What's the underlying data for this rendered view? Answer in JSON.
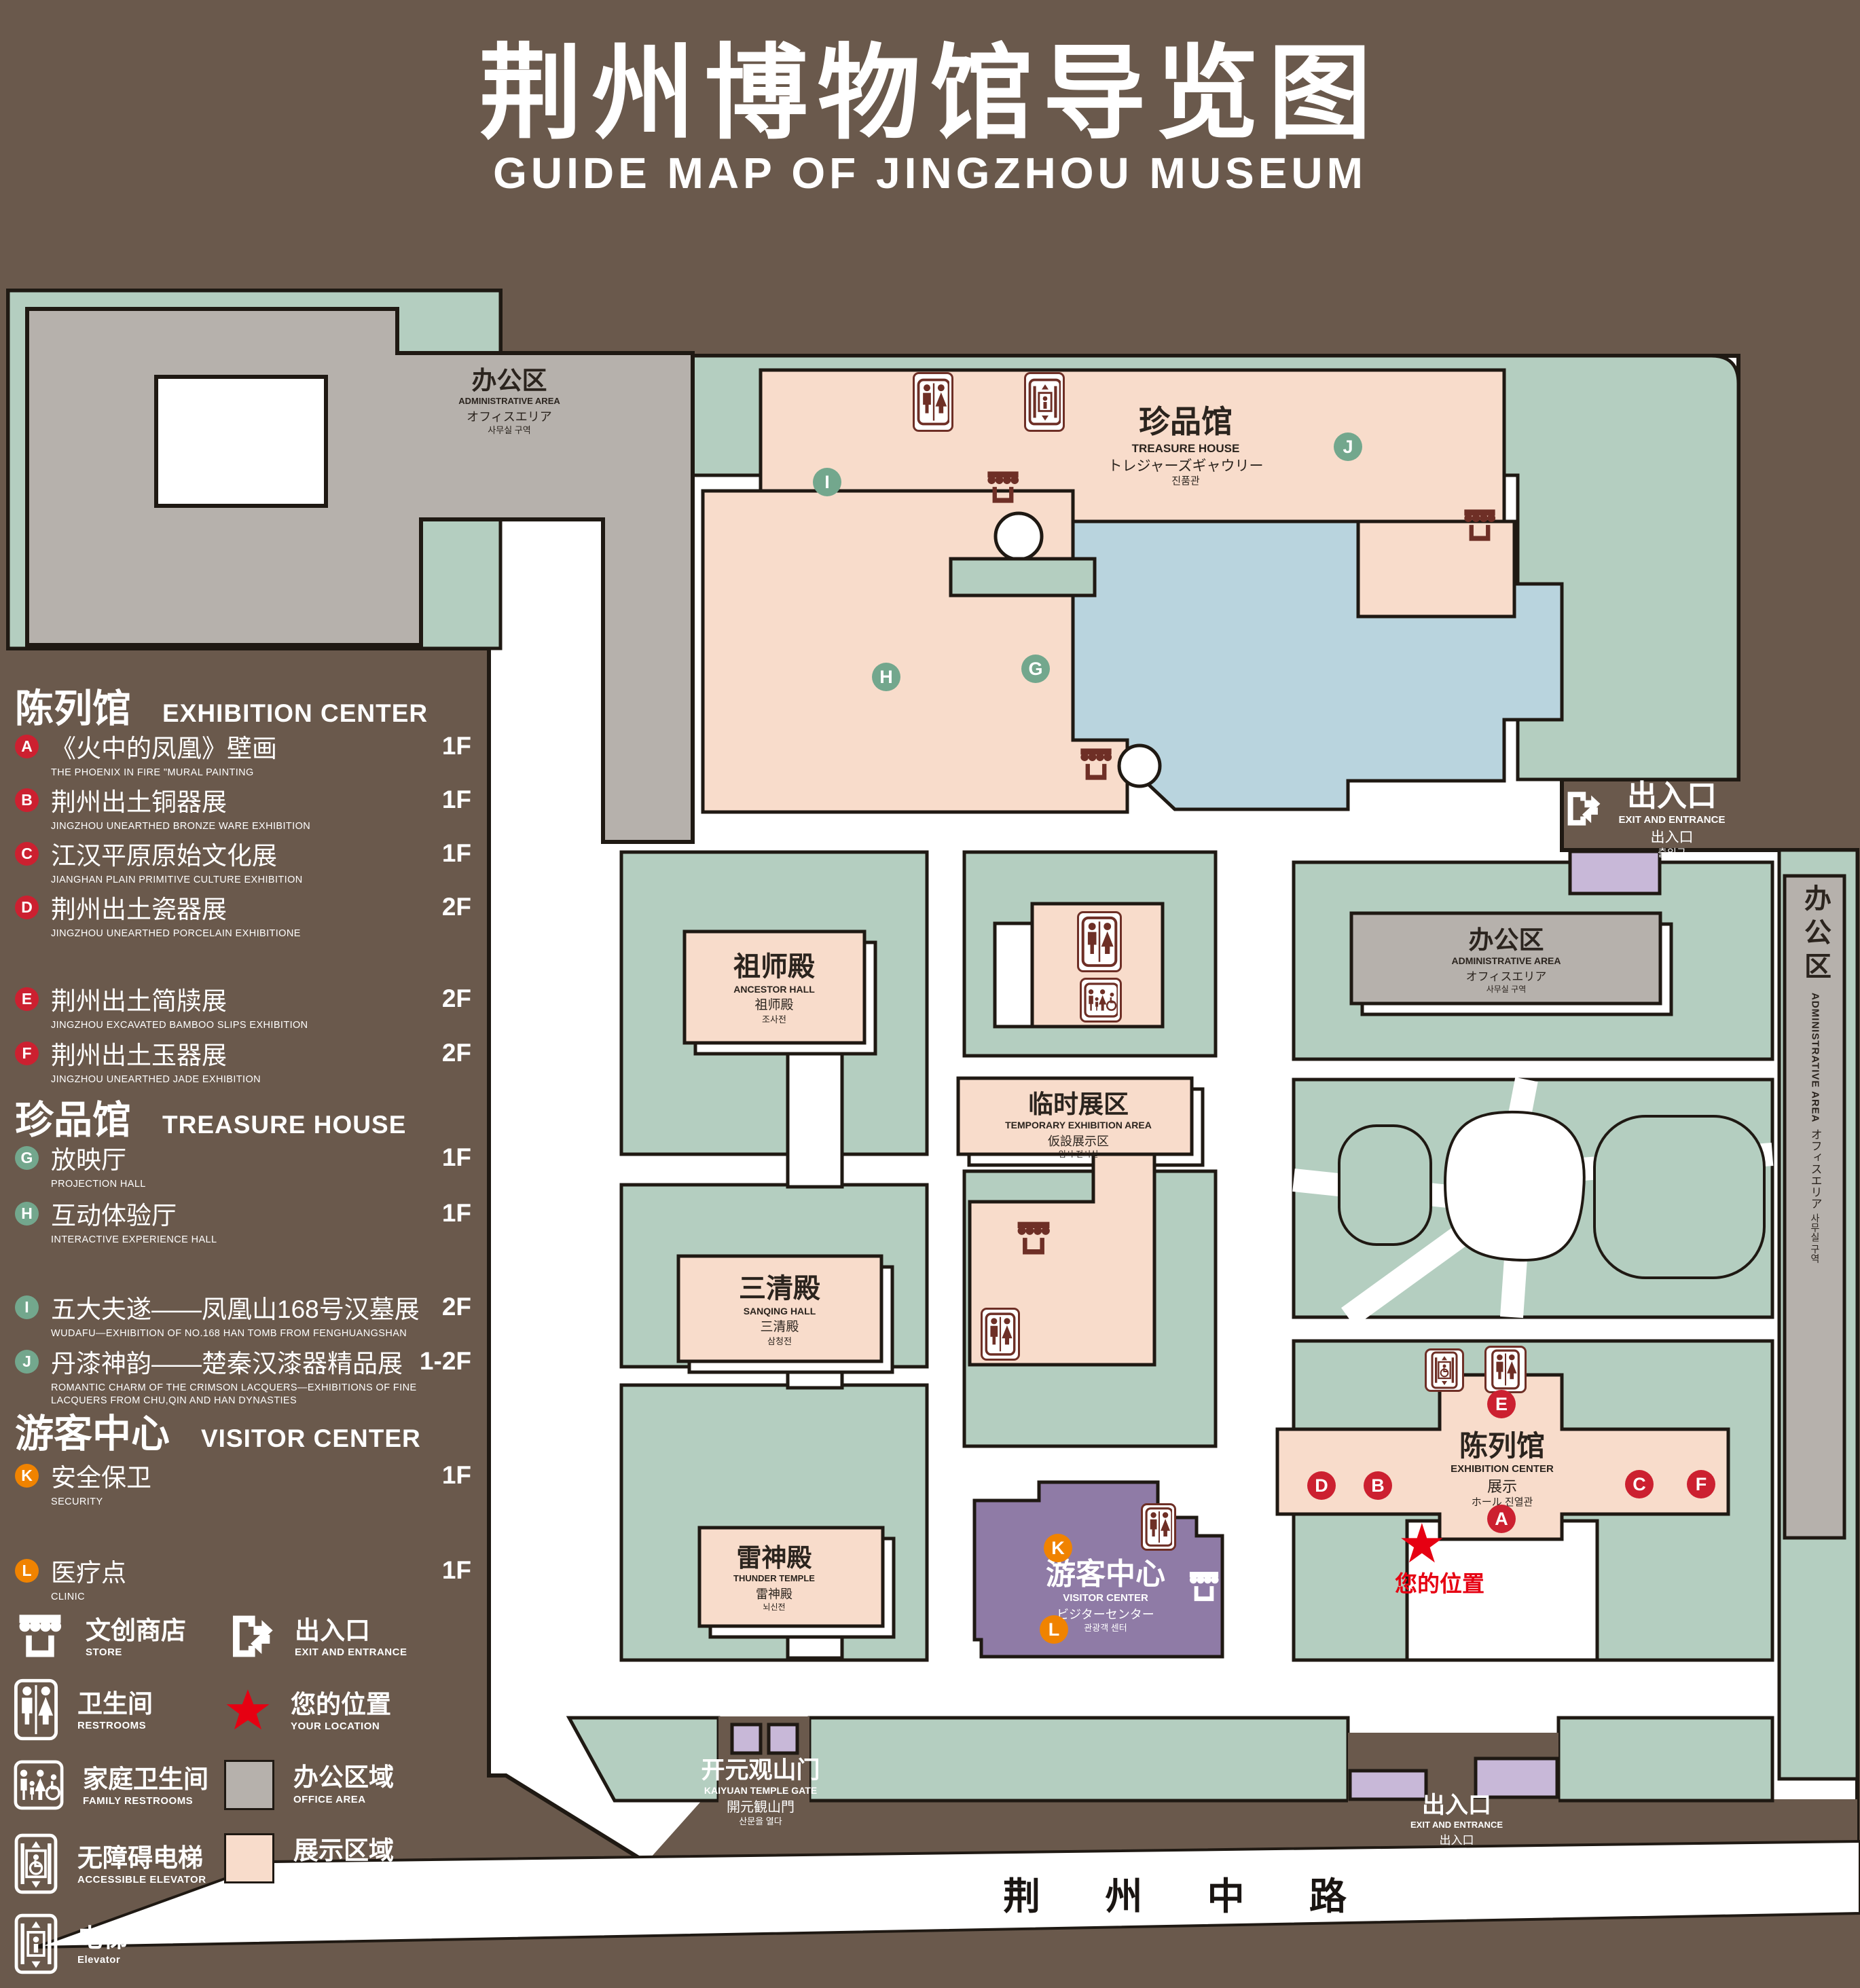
{
  "title": {
    "zh": "荆州博物馆导览图",
    "en": "GUIDE MAP OF JINGZHOU MUSEUM"
  },
  "colors": {
    "background": "#6A594C",
    "green_area": "#B4CEC0",
    "display_area": "#F8DCCB",
    "office_area": "#B6B1AC",
    "water": "#B9D4DE",
    "visitor_center": "#8F7BA6",
    "purple_light": "#C8B8D8",
    "marker_red": "#CC2030",
    "marker_green": "#73A78D",
    "marker_orange": "#F08300",
    "icon_maroon": "#6E2F26",
    "location_red": "#E60012"
  },
  "legend": {
    "sections": [
      {
        "zh": "陈列馆",
        "en": "EXHIBITION CENTER",
        "items": [
          {
            "letter": "A",
            "zh": "《火中的凤凰》壁画",
            "en": "THE PHOENIX IN FIRE \"MURAL PAINTING",
            "floor": "1F"
          },
          {
            "letter": "B",
            "zh": "荆州出土铜器展",
            "en": "JINGZHOU UNEARTHED BRONZE WARE EXHIBITION",
            "floor": "1F"
          },
          {
            "letter": "C",
            "zh": "江汉平原原始文化展",
            "en": "JIANGHAN PLAIN PRIMITIVE CULTURE EXHIBITION",
            "floor": "1F"
          },
          {
            "letter": "D",
            "zh": "荆州出土瓷器展",
            "en": "JINGZHOU UNEARTHED PORCELAIN EXHIBITIONE",
            "floor": "2F"
          },
          {
            "letter": "E",
            "zh": "荆州出土简牍展",
            "en": "JINGZHOU EXCAVATED BAMBOO SLIPS EXHIBITION",
            "floor": "2F"
          },
          {
            "letter": "F",
            "zh": "荆州出土玉器展",
            "en": "JINGZHOU UNEARTHED JADE EXHIBITION",
            "floor": "2F"
          }
        ]
      },
      {
        "zh": "珍品馆",
        "en": "TREASURE HOUSE",
        "items": [
          {
            "letter": "G",
            "zh": "放映厅",
            "en": "PROJECTION HALL",
            "floor": "1F"
          },
          {
            "letter": "H",
            "zh": "互动体验厅",
            "en": "INTERACTIVE EXPERIENCE HALL",
            "floor": "1F"
          },
          {
            "letter": "I",
            "zh": "五大夫遂——凤凰山168号汉墓展",
            "en": "WUDAFU—EXHIBITION OF NO.168 HAN TOMB FROM FENGHUANGSHAN",
            "floor": "2F"
          },
          {
            "letter": "J",
            "zh": "丹漆神韵——楚秦汉漆器精品展",
            "en": "ROMANTIC CHARM OF THE CRIMSON LACQUERS—EXHIBITIONS OF FINE LACQUERS FROM CHU,QIN AND HAN DYNASTIES",
            "floor": "1-2F"
          }
        ]
      },
      {
        "zh": "游客中心",
        "en": "VISITOR CENTER",
        "items": [
          {
            "letter": "K",
            "zh": "安全保卫",
            "en": "SECURITY",
            "floor": "1F"
          },
          {
            "letter": "L",
            "zh": "医疗点",
            "en": "CLINIC",
            "floor": "1F"
          }
        ]
      }
    ],
    "symbols_left": [
      {
        "icon": "store-icon",
        "zh": "文创商店",
        "en": "STORE"
      },
      {
        "icon": "restroom-icon",
        "zh": "卫生间",
        "en": "RESTROOMS"
      },
      {
        "icon": "family-restroom-icon",
        "zh": "家庭卫生间",
        "en": "FAMILY RESTROOMS"
      },
      {
        "icon": "accessible-elevator-icon",
        "zh": "无障碍电梯",
        "en": "ACCESSIBLE  ELEVATOR"
      },
      {
        "icon": "elevator-icon",
        "zh": "电梯",
        "en": "Elevator"
      }
    ],
    "symbols_right": [
      {
        "icon": "exit-icon",
        "zh": "出入口",
        "en": "EXIT AND ENTRANCE"
      },
      {
        "icon": "location-star-icon",
        "zh": "您的位置",
        "en": "YOUR LOCATION"
      },
      {
        "icon": "office-swatch",
        "zh": "办公区域",
        "en": "OFFICE AREA"
      },
      {
        "icon": "display-swatch",
        "zh": "展示区域",
        "en": "DISPLAY AREA"
      }
    ]
  },
  "map": {
    "road_label": "荆 州 中 路",
    "your_location": {
      "star": "★",
      "zh": "您的位置"
    },
    "buildings": {
      "office": {
        "zh": "办公区",
        "en": "ADMINISTRATIVE AREA",
        "jp": "オフィスエリア",
        "kr": "사무실 구역"
      },
      "treasure_house": {
        "zh": "珍品馆",
        "en": "TREASURE HOUSE",
        "jp": "トレジャーズギャウリー",
        "kr": "진품관"
      },
      "ancestor_hall": {
        "zh": "祖师殿",
        "en": "ANCESTOR HALL",
        "jp": "祖师殿",
        "kr": "조사전"
      },
      "temporary_exhibition": {
        "zh": "临时展区",
        "en": "TEMPORARY EXHIBITION AREA",
        "jp": "仮設展示区",
        "kr": "임시 전시실"
      },
      "sanqing_hall": {
        "zh": "三清殿",
        "en": "SANQING HALL",
        "jp": "三清殿",
        "kr": "삼청전"
      },
      "thunder_temple": {
        "zh": "雷神殿",
        "en": "THUNDER TEMPLE",
        "jp": "雷神殿",
        "kr": "뇌신전"
      },
      "visitor_center": {
        "zh": "游客中心",
        "en": "VISITOR CENTER",
        "jp": "ビジターセンター",
        "kr": "관광객 센터"
      },
      "exhibition_center": {
        "zh": "陈列馆",
        "en": "EXHIBITION CENTER",
        "jp": "展示",
        "jp2": "ホール",
        "kr": "진열관"
      }
    },
    "gates": {
      "kaiyuan": {
        "zh": "开元观山门",
        "en": "KAIYUAN TEMPLE GATE",
        "jp": "開元観山門",
        "kr": "산문을 열다"
      },
      "exit_ne": {
        "zh": "出入口",
        "en": "EXIT AND ENTRANCE",
        "jp": "出入口",
        "kr": "출입구"
      },
      "exit_s": {
        "zh": "出入口",
        "en": "EXIT AND ENTRANCE",
        "jp": "出入口",
        "kr": "출입구"
      }
    },
    "markers": [
      {
        "letter": "A"
      },
      {
        "letter": "B"
      },
      {
        "letter": "C"
      },
      {
        "letter": "D"
      },
      {
        "letter": "E"
      },
      {
        "letter": "F"
      },
      {
        "letter": "G"
      },
      {
        "letter": "H"
      },
      {
        "letter": "I"
      },
      {
        "letter": "J"
      },
      {
        "letter": "K"
      },
      {
        "letter": "L"
      }
    ]
  }
}
